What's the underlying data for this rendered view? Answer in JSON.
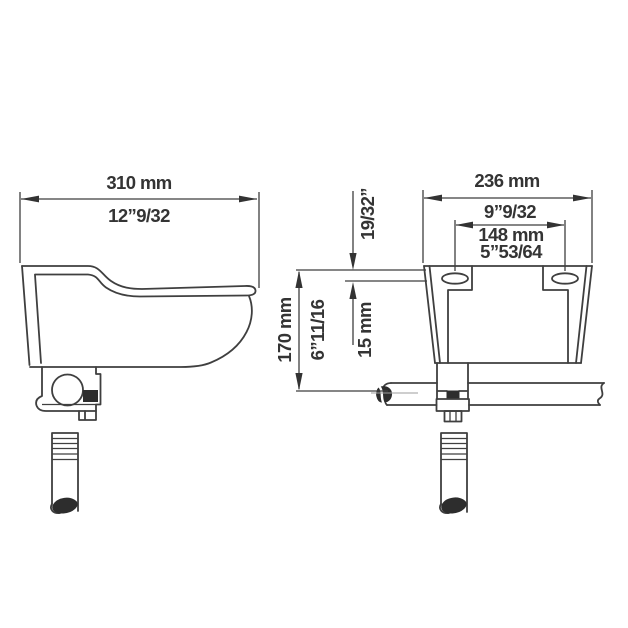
{
  "drawing_title": "drinking-bowl-technical-drawing",
  "colors": {
    "background": "#ffffff",
    "line": "#3f3f3f",
    "text": "#343434",
    "centerline": "#9e9e9e"
  },
  "views": {
    "side_view": {
      "name": "bowl-side-view"
    },
    "front_view": {
      "name": "bowl-front-view"
    }
  },
  "dimensions": {
    "side_width_mm": "310 mm",
    "side_width_in": "12”9/32",
    "front_width_mm": "236 mm",
    "front_width_in": "9”9/32",
    "hole_spacing_mm": "148 mm",
    "hole_spacing_in": "5”53/64",
    "height_mm": "170 mm",
    "height_in": "6”11/16",
    "top_to_hole_in": "19/32”",
    "top_to_hole_mm": "15 mm"
  }
}
